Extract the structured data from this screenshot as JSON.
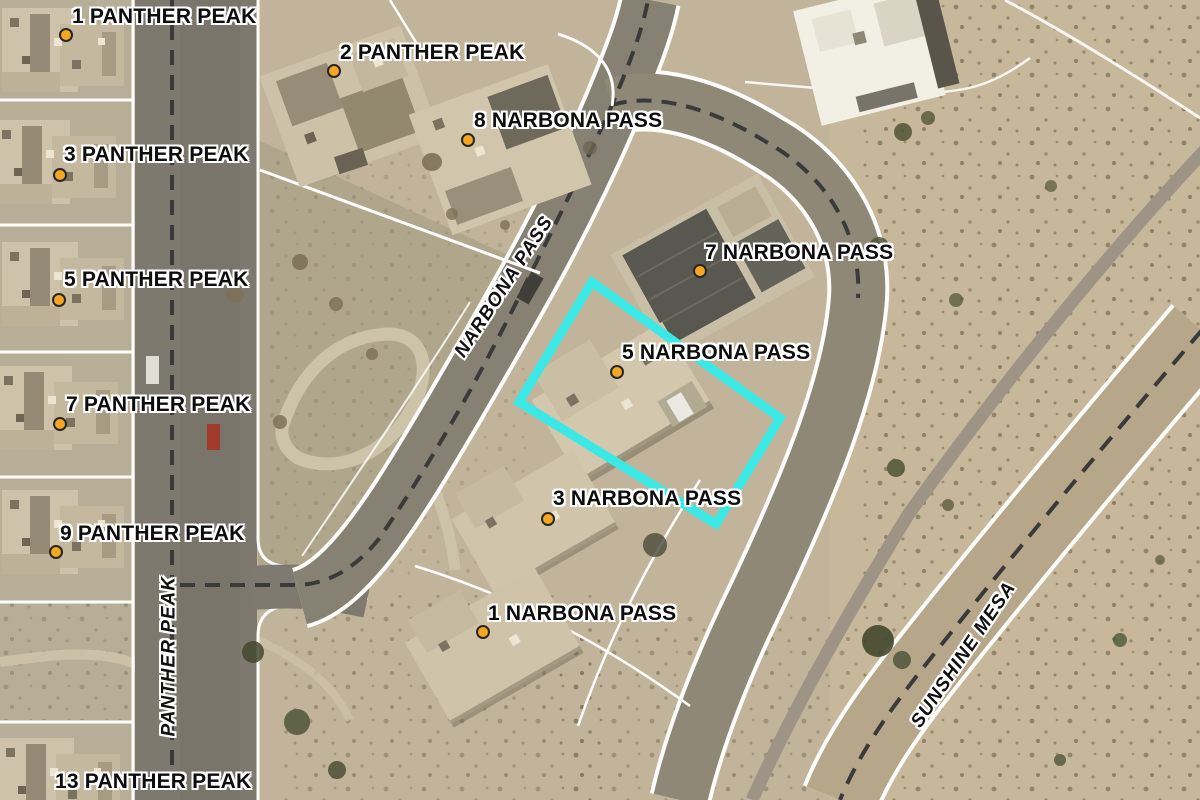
{
  "map": {
    "address_labels": [
      {
        "text": "1 PANTHER PEAK"
      },
      {
        "text": "2 PANTHER PEAK"
      },
      {
        "text": "8 NARBONA PASS"
      },
      {
        "text": "3 PANTHER PEAK"
      },
      {
        "text": "7 NARBONA PASS"
      },
      {
        "text": "5 PANTHER PEAK"
      },
      {
        "text": "5 NARBONA PASS"
      },
      {
        "text": "7 PANTHER PEAK"
      },
      {
        "text": "3 NARBONA PASS"
      },
      {
        "text": "9 PANTHER PEAK"
      },
      {
        "text": "1 NARBONA PASS"
      },
      {
        "text": "13 PANTHER PEAK"
      }
    ],
    "street_labels": {
      "narbona": "NARBONA PASS",
      "panther": "PANTHER PEAK",
      "sunshine": "SUNSHINE MESA"
    },
    "highlighted_parcel": "5 NARBONA PASS",
    "colors": {
      "highlight": "#3ae9e6",
      "marker": "#f6a623",
      "label_text": "#0d0d0d",
      "halo": "#ffffff",
      "centerline": "#3a3a3a"
    }
  }
}
